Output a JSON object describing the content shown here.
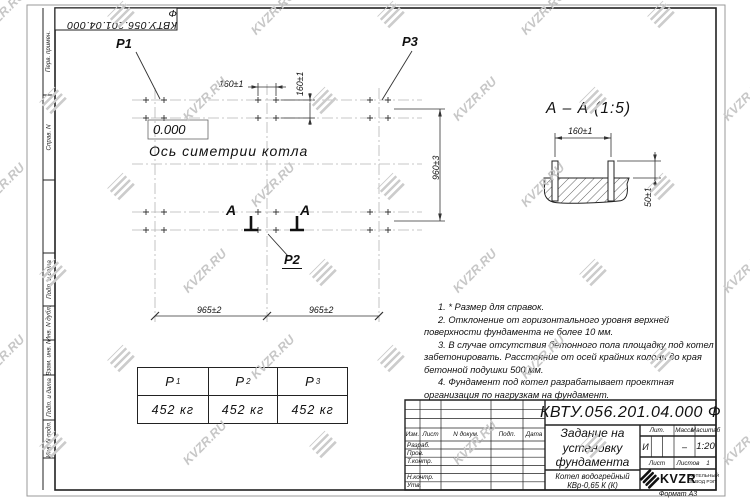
{
  "watermark": {
    "text": "KVZR.RU"
  },
  "top_stamp": {
    "doc_number_rotated": "КВТУ.056.201.04.000  Ф"
  },
  "sidebar": {
    "items": [
      {
        "label": "Перв. примен."
      },
      {
        "label": "Справ. N"
      },
      {
        "label": "Подп. и дата"
      },
      {
        "label": "Инв. N дубл."
      },
      {
        "label": "Взам. инв. N"
      },
      {
        "label": "Подп. и дата"
      },
      {
        "label": "Инв. N подл."
      }
    ]
  },
  "plan": {
    "point_labels": {
      "p1": "P1",
      "p2": "P2",
      "p3": "P3"
    },
    "elevation": "0.000",
    "axis_label": "Ось симетрии котла",
    "section_letter_left": "А",
    "section_letter_right": "А",
    "dim_160_h": "160±1",
    "dim_160_v": "160±1",
    "dim_960_v": "960±3",
    "dim_965_left": "965±2",
    "dim_965_right": "965±2"
  },
  "section_view": {
    "title": "А – А (1:5)",
    "dim_160": "160±1",
    "dim_50": "50±1"
  },
  "notes": {
    "items": [
      "1.  * Размер для справок.",
      "2.  Отклонение от горизонтального уровня верхней поверхности фундамента не более 10 мм.",
      "3.  В случае отсутствия бетонного пола площадку под котел забетонировать. Расстояние от осей крайних колонн до края бетонной подушки 500 мм.",
      "4.  Фундамент под котел разрабатывает проектная организация по нагрузкам на фундамент."
    ]
  },
  "load_table": {
    "columns": [
      {
        "name": "P",
        "sub": "1",
        "value": "452 кг"
      },
      {
        "name": "P",
        "sub": "2",
        "value": "452 кг"
      },
      {
        "name": "P",
        "sub": "3",
        "value": "452 кг"
      }
    ]
  },
  "title_block": {
    "doc_number": "КВТУ.056.201.04.000  Ф",
    "doc_title_lines": [
      "Задание на",
      "установку",
      "фундамента"
    ],
    "product_lines": [
      "Котел водогрейный",
      "КВр-0,65 К (К)"
    ],
    "header_columns": [
      "Изм.",
      "Лист",
      "N докум.",
      "Подп.",
      "Дата"
    ],
    "signature_rows": [
      "Разраб.",
      "Пров.",
      "Т.контр.",
      "",
      "Н.контр.",
      "Утв."
    ],
    "lit_label": "Лит.",
    "lit_value": "И",
    "mass_label": "Масса",
    "mass_value": "–",
    "scale_label": "Масштаб",
    "scale_value": "1:20",
    "sheet_label": "Лист",
    "sheets_label": "Листов",
    "sheets_value": "1",
    "company": {
      "logo_text": "KVZR",
      "sub_lines": [
        "КОТЕЛЬНЫЙ",
        "ЗАВОД РЭП"
      ]
    },
    "format_note": "Формат А3"
  }
}
